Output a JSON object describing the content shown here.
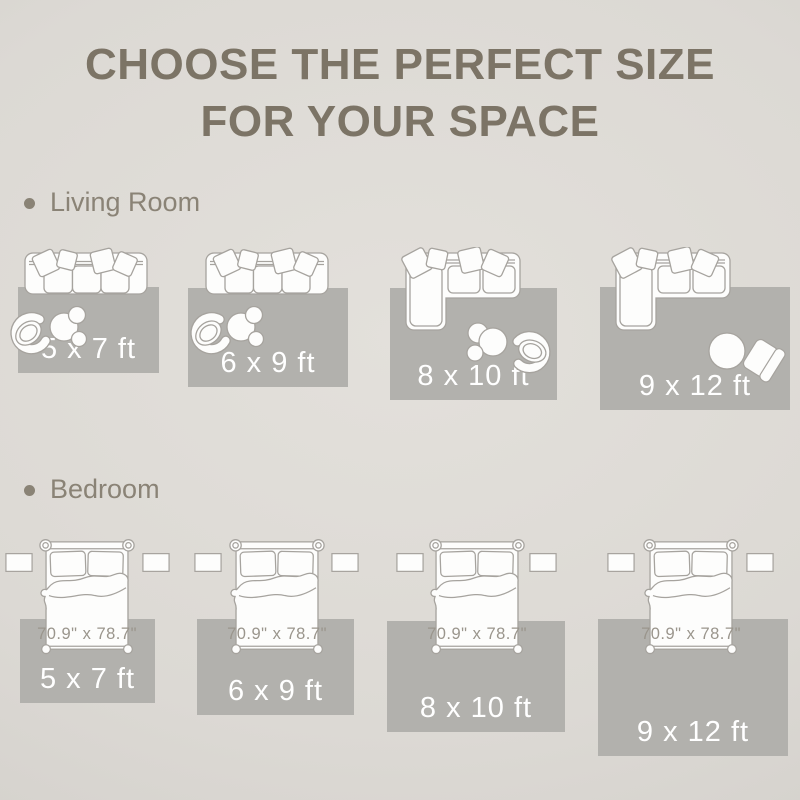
{
  "title": {
    "line1": "CHOOSE THE PERFECT SIZE",
    "line2": "FOR YOUR SPACE"
  },
  "sections": [
    {
      "label": "Living Room",
      "rugs": [
        {
          "size": "5 x 7 ft"
        },
        {
          "size": "6 x 9 ft"
        },
        {
          "size": "8 x 10 ft"
        },
        {
          "size": "9 x 12 ft"
        }
      ]
    },
    {
      "label": "Bedroom",
      "bed_dimensions": "70.9\" x 78.7\"",
      "rugs": [
        {
          "size": "5 x 7 ft"
        },
        {
          "size": "6 x 9 ft"
        },
        {
          "size": "8 x 10 ft"
        },
        {
          "size": "9 x 12 ft"
        }
      ]
    }
  ],
  "icons": {
    "living_room": [
      "sofa-icon",
      "sectional-sofa-icon",
      "accent-chair-icon",
      "coffee-table-icon",
      "round-table-icon",
      "armchair-icon"
    ],
    "bedroom": [
      "bed-icon",
      "nightstand-icon"
    ]
  },
  "colors": {
    "background": "#e3e0db",
    "rug": "#b2b1ad",
    "title_text": "#7c7466",
    "section_text": "#8a8376",
    "furniture_outline": "#a6a39e",
    "furniture_fill": "#fdfdfc",
    "rug_label_text": "#ffffff",
    "bed_label_text": "#9a958c"
  }
}
